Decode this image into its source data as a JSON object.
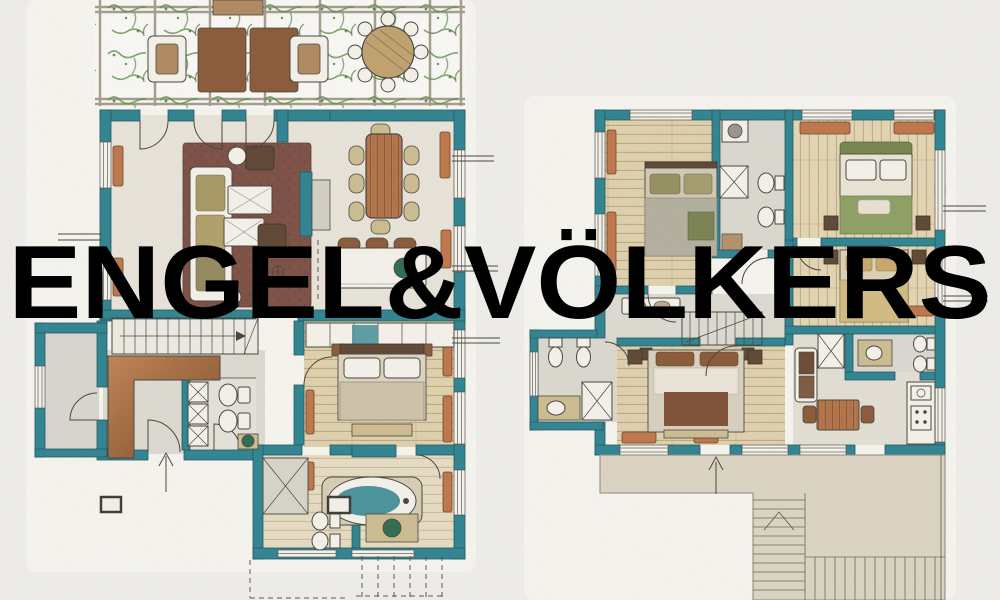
{
  "watermark": {
    "text": "ENGEL&VÖLKERS"
  },
  "plans": [
    {
      "id": "ground-floor-plan"
    },
    {
      "id": "upper-floor-plan"
    }
  ],
  "colors": {
    "background": "#f0efec",
    "paper": "#f8f6f1",
    "wall_teal": "#2e8492",
    "ink": "#47443c",
    "radiator": "#c0764a",
    "rug_brown": "#7d5044",
    "water_teal": "#4a939c",
    "terrace_beige": "#ddd5c4",
    "furniture_brown": "#8a5a38",
    "vine_green": "#5f8f4c",
    "counter_white": "#f6f3ec",
    "tile_gray": "#dcd9d1",
    "watermark_white": "rgba(255,255,255,0.62)"
  }
}
